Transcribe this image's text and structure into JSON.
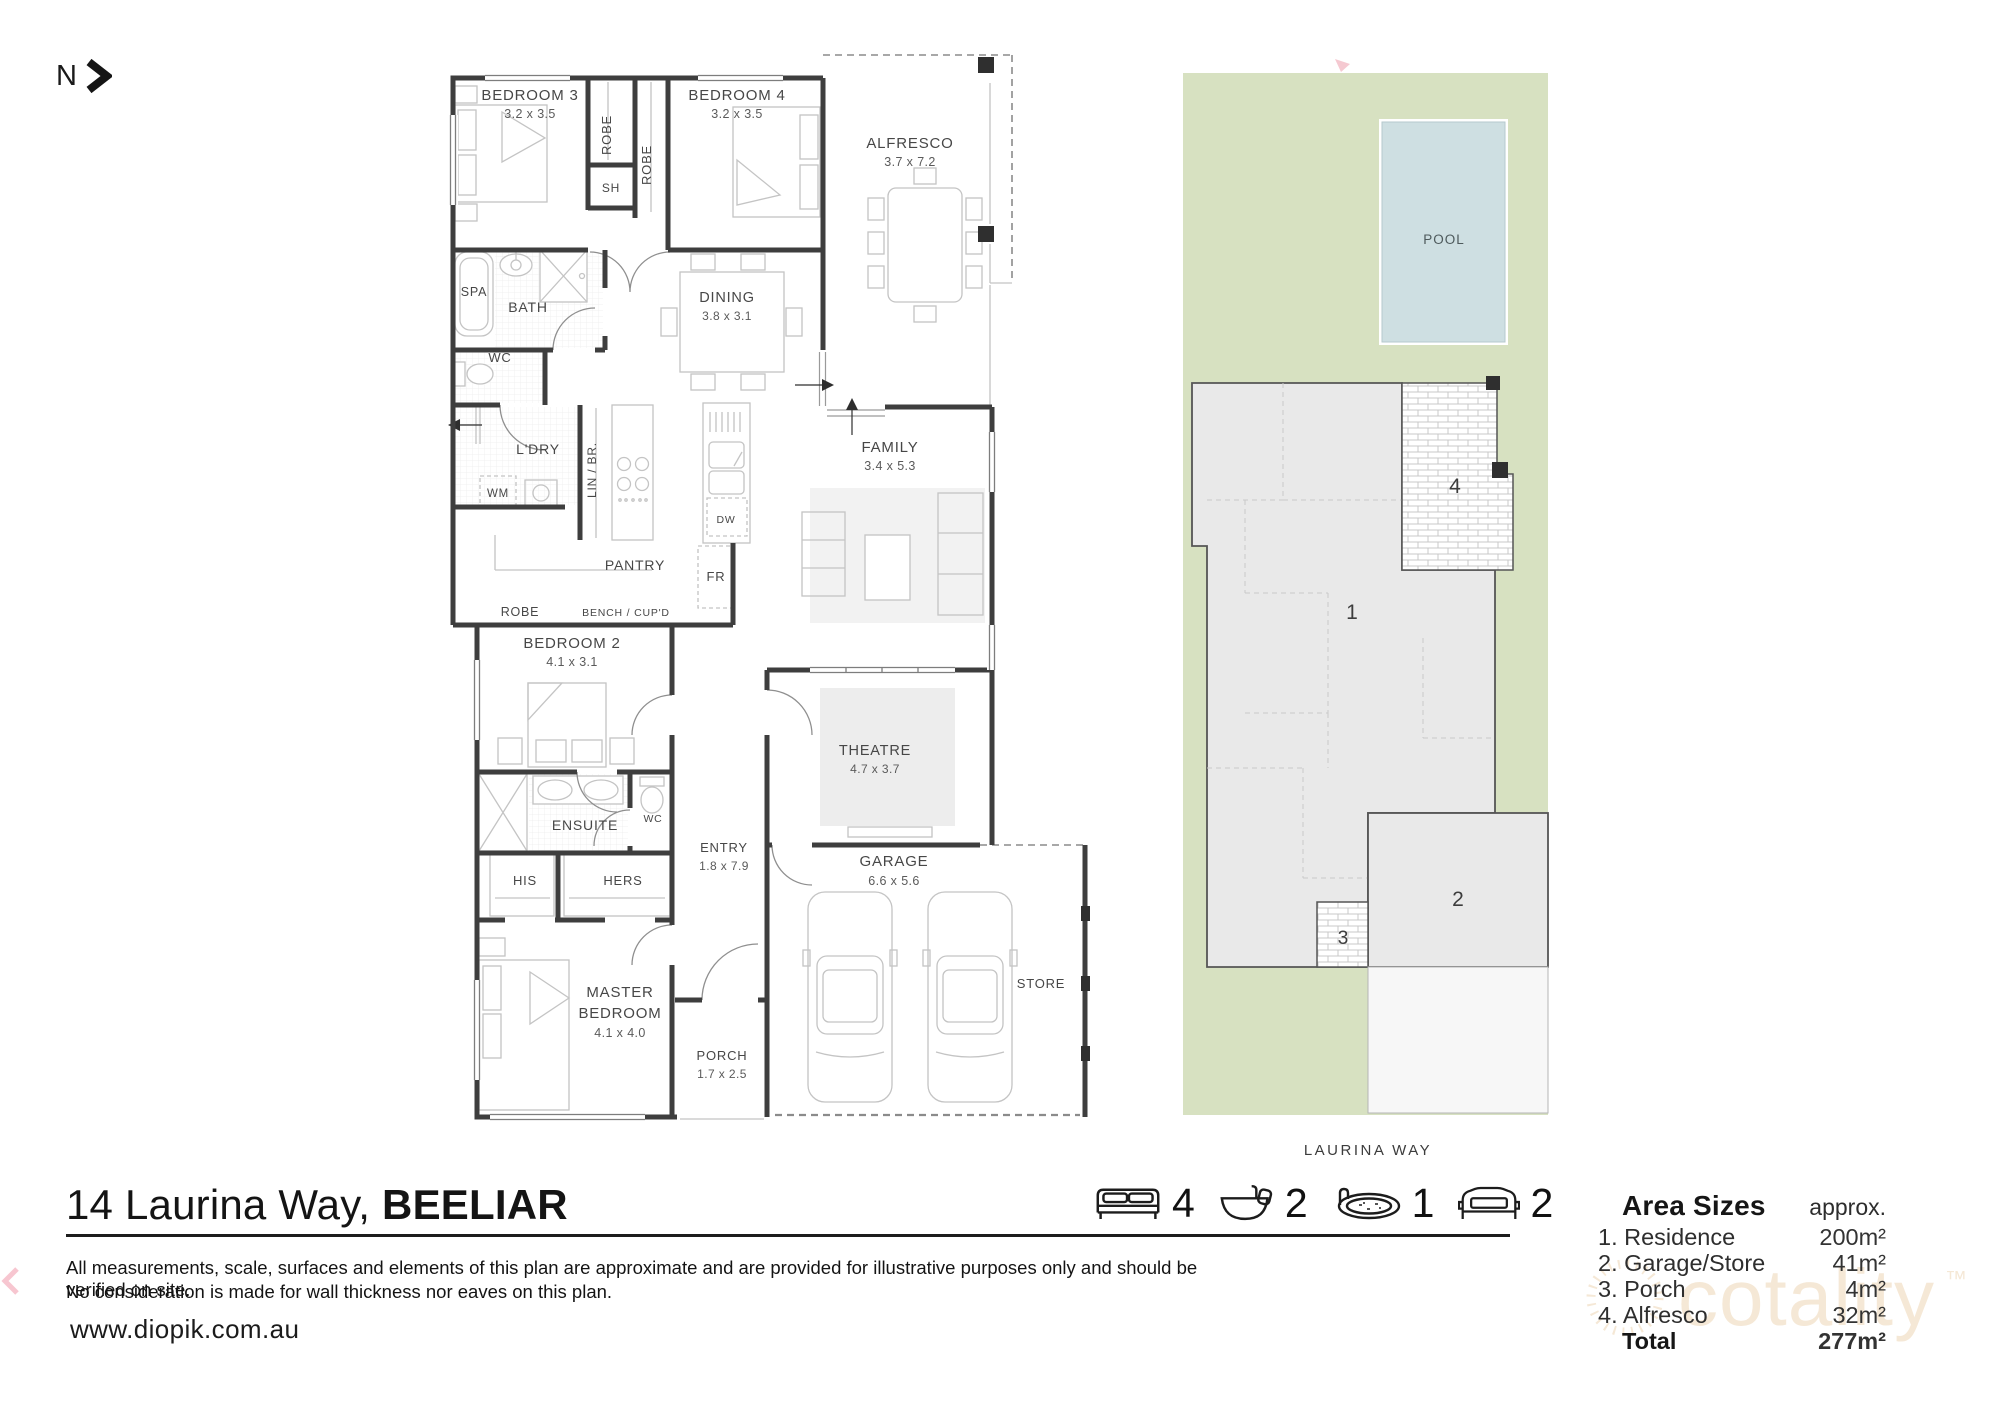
{
  "page": {
    "north_label": "N",
    "title_address": "14 Laurina Way,",
    "title_suburb": "BEELIAR",
    "disclaimer_line1": "All measurements, scale, surfaces and elements of this plan are approximate and are provided for illustrative purposes only and should be verified on site.",
    "disclaimer_line2": "No consideration is made for wall thickness nor eaves on this plan.",
    "website": "www.diopik.com.au",
    "watermark": "cotality"
  },
  "rooms": {
    "bedroom3": {
      "name": "BEDROOM 3",
      "dims": "3.2 x 3.5"
    },
    "bedroom4": {
      "name": "BEDROOM 4",
      "dims": "3.2  x 3.5"
    },
    "alfresco": {
      "name": "ALFRESCO",
      "dims": "3.7 x 7.2"
    },
    "dining": {
      "name": "DINING",
      "dims": "3.8 x 3.1"
    },
    "family": {
      "name": "FAMILY",
      "dims": "3.4  x 5.3"
    },
    "theatre": {
      "name": "THEATRE",
      "dims": "4.7 x 3.7"
    },
    "garage": {
      "name": "GARAGE",
      "dims": "6.6 x 5.6"
    },
    "bedroom2": {
      "name": "BEDROOM 2",
      "dims": "4.1 x 3.1"
    },
    "master": {
      "line1": "MASTER",
      "line2": "BEDROOM",
      "dims": "4.1 x 4.0"
    },
    "entry": {
      "name": "ENTRY",
      "dims": "1.8 x 7.9"
    },
    "porch": {
      "name": "PORCH",
      "dims": "1.7 x 2.5"
    },
    "store": {
      "name": "STORE"
    },
    "pantry": {
      "name": "PANTRY"
    },
    "bench": {
      "name": "BENCH / CUP'D"
    },
    "robe_a": {
      "name": "ROBE"
    },
    "robe_b": {
      "name": "ROBE"
    },
    "robe_c": {
      "name": "ROBE"
    },
    "sh": {
      "name": "SH"
    },
    "spa": {
      "name": "SPA"
    },
    "bath": {
      "name": "BATH"
    },
    "wc": {
      "name": "WC"
    },
    "wc2": {
      "name": "WC"
    },
    "ldry": {
      "name": "L'DRY"
    },
    "wm": {
      "name": "WM"
    },
    "linbr": {
      "name": "LIN / BR."
    },
    "fr": {
      "name": "FR"
    },
    "dw": {
      "name": "DW"
    },
    "ensuite": {
      "name": "ENSUITE"
    },
    "his": {
      "name": "HIS"
    },
    "hers": {
      "name": "HERS"
    }
  },
  "site": {
    "pool_label": "POOL",
    "street_label": "LAURINA WAY",
    "labels": {
      "residence": "1",
      "garage": "2",
      "porch": "3",
      "alfresco": "4"
    }
  },
  "summary": {
    "beds": {
      "count": "4"
    },
    "baths": {
      "count": "2"
    },
    "pools": {
      "count": "1"
    },
    "cars": {
      "count": "2"
    }
  },
  "area_sizes": {
    "title": "Area Sizes",
    "approx_label": "approx.",
    "rows": [
      {
        "label": "1. Residence",
        "value": "200m²"
      },
      {
        "label": "2. Garage/Store",
        "value": "41m²"
      },
      {
        "label": "3. Porch",
        "value": "4m²"
      },
      {
        "label": "4. Alfresco",
        "value": "32m²"
      }
    ],
    "total": {
      "label": "Total",
      "value": "277m²"
    }
  }
}
